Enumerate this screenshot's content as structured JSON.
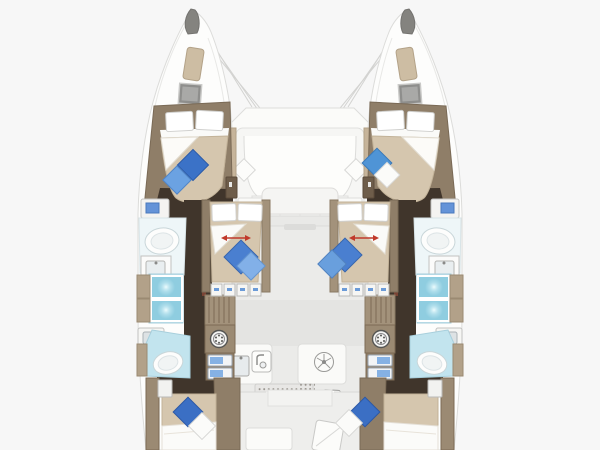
{
  "page": {
    "title": "Catamaran interior layout floor plan",
    "description": "Top-down deck plan of a sailing catamaran with six double cabins, four bathrooms, forward cockpit lounge, salon galley and aft cockpit"
  },
  "vessel": {
    "hulls": [
      "port",
      "starboard"
    ],
    "areas": [
      "bow-trampoline",
      "forward-crossbeam",
      "forward-cockpit-lounge",
      "salon",
      "galley",
      "aft-cockpit"
    ],
    "cabins": [
      {
        "id": "port-forward-cabin",
        "berth": "double",
        "pillows": "white x2",
        "cushions": [
          "blue",
          "light-blue"
        ]
      },
      {
        "id": "starboard-forward-cabin",
        "berth": "double",
        "pillows": "white x2",
        "cushions": [
          "blue",
          "white"
        ]
      },
      {
        "id": "port-mid-cabin",
        "berth": "double",
        "pillows": "white x2",
        "cushions": [
          "blue",
          "light-blue"
        ],
        "marker": "red-slide-arrow"
      },
      {
        "id": "starboard-mid-cabin",
        "berth": "double",
        "pillows": "white x2",
        "cushions": [
          "blue",
          "light-blue"
        ],
        "marker": "red-slide-arrow"
      },
      {
        "id": "port-aft-cabin",
        "berth": "double",
        "cushions": [
          "blue",
          "white"
        ]
      },
      {
        "id": "starboard-aft-cabin",
        "berth": "double",
        "cushions": [
          "blue",
          "white"
        ]
      }
    ],
    "bathrooms": [
      {
        "id": "port-forward-head",
        "fixtures": [
          "shower-tray",
          "sink",
          "shower-stall-x2"
        ]
      },
      {
        "id": "starboard-forward-head",
        "fixtures": [
          "shower-tray",
          "sink",
          "shower-stall-x2"
        ]
      },
      {
        "id": "port-aft-head",
        "fixtures": [
          "sink",
          "toilet"
        ]
      },
      {
        "id": "starboard-aft-head",
        "fixtures": [
          "sink",
          "toilet"
        ]
      }
    ],
    "equipment": [
      "deck-hatch-x2",
      "sunpad-x2",
      "washing-machine-x2",
      "fridge-drawers-x2",
      "galley-sink",
      "dishwasher",
      "extractor-fan",
      "vent-grille",
      "speaker-grille",
      "small-sink",
      "stove-burner",
      "cockpit-table",
      "cockpit-bench",
      "tv-cabinet-x2"
    ],
    "icons": [
      "washing-machine-icon",
      "faucet-icon",
      "fan-icon",
      "burner-icon",
      "tv-screen-icon"
    ]
  },
  "palette": {
    "background": "#f7f7f7",
    "deck_white": "#fdfdfc",
    "hull_wall_tan": "#8f7e68",
    "cabinet_tan": "#a3927b",
    "bedspread_tan": "#d5c6ae",
    "floor_dark_brown": "#40352b",
    "bathroom_cyan": "#c2e4ee",
    "shower_glass": "#8fcde0",
    "cushion_blue": "#3b72c7",
    "cushion_light_blue": "#82b0e8",
    "drawer_blue": "#85b1e4",
    "arrow_red": "#c0392b",
    "salon_floor": "#ebebe9"
  }
}
